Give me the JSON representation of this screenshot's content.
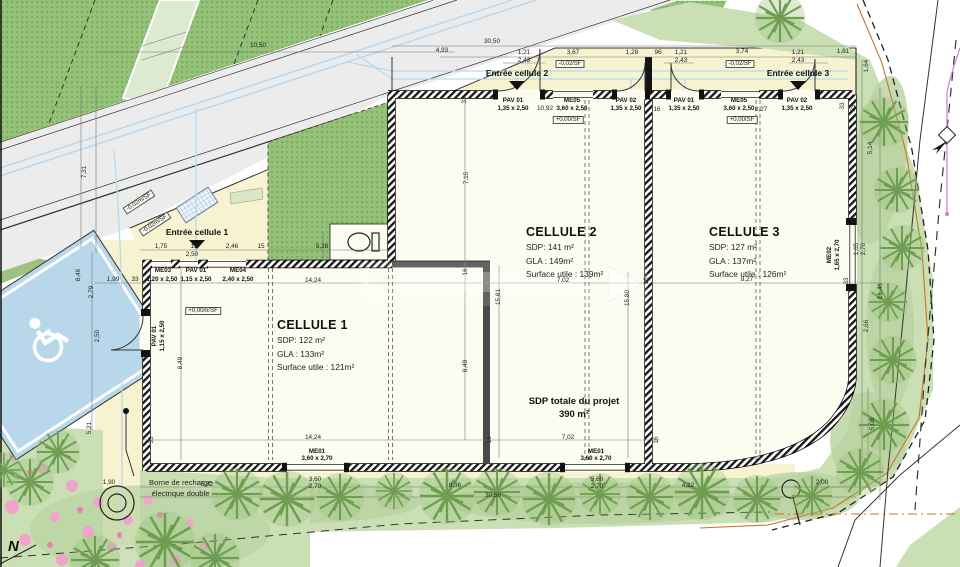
{
  "plan_title": "Plan de masse - projet de 3 cellules commerciales",
  "cells": [
    {
      "title": "CELLULE 1",
      "sdp": "SDP: 122 m²",
      "gla": "GLA : 133m²",
      "su": "Surface utile : 121m²"
    },
    {
      "title": "CELLULE 2",
      "sdp": "SDP: 141 m²",
      "gla": "GLA : 149m²",
      "su": "Surface utile : 139m²"
    },
    {
      "title": "CELLULE 3",
      "sdp": "SDP: 127 m²",
      "gla": "GLA : 137m²",
      "su": "Surface utile : 126m²"
    }
  ],
  "total": {
    "line1": "SDP totale du projet",
    "line2": "390 m²"
  },
  "charging": {
    "line1": "Borne de recharge",
    "line2": "électrique double"
  },
  "north": "N",
  "colors": {
    "site_yellow": "#f7f3d0",
    "building_white": "#fdfcf1",
    "parcel_green": "#94c279",
    "verge_green": "#cadfb4",
    "parking_blue": "#b9d7ea",
    "utility_blue": "#b7d9ee",
    "boundary_orange": "#c8732d",
    "utility_purple": "#c983c9",
    "flower_pink": "#f0a4cc"
  },
  "labels": [
    {
      "t": "10,50",
      "x": 258,
      "y": 46
    },
    {
      "t": "30,50",
      "x": 492,
      "y": 42
    },
    {
      "t": "4,93",
      "x": 442,
      "y": 51
    },
    {
      "t": "1,21",
      "x": 524,
      "y": 53
    },
    {
      "t": "2,43",
      "x": 524,
      "y": 61
    },
    {
      "t": "3,67",
      "x": 573,
      "y": 53
    },
    {
      "t": "1,28",
      "x": 632,
      "y": 53
    },
    {
      "t": "96",
      "x": 658,
      "y": 53
    },
    {
      "t": "1,21",
      "x": 681,
      "y": 53
    },
    {
      "t": "2,43",
      "x": 681,
      "y": 61
    },
    {
      "t": "3,74",
      "x": 742,
      "y": 52
    },
    {
      "t": "1,21",
      "x": 798,
      "y": 53
    },
    {
      "t": "2,43",
      "x": 798,
      "y": 61
    },
    {
      "t": "1,81",
      "x": 843,
      "y": 52
    },
    {
      "t": "7,31",
      "x": 85,
      "y": 172,
      "r": -90
    },
    {
      "t": "1,64",
      "x": 867,
      "y": 66,
      "r": -90
    },
    {
      "t": "33",
      "x": 843,
      "y": 106,
      "r": -90
    },
    {
      "t": "5,14",
      "x": 871,
      "y": 148,
      "r": -90
    },
    {
      "t": "33",
      "x": 465,
      "y": 100,
      "r": -90
    },
    {
      "t": "10,92",
      "x": 545,
      "y": 109
    },
    {
      "t": "16",
      "x": 657,
      "y": 110
    },
    {
      "t": "8,27",
      "x": 761,
      "y": 110
    },
    {
      "t": "33",
      "x": 854,
      "y": 108,
      "r": -90
    },
    {
      "t": "7,15",
      "x": 467,
      "y": 178,
      "r": -90
    },
    {
      "t": "5,28",
      "x": 322,
      "y": 247
    },
    {
      "t": "1,75",
      "x": 161,
      "y": 247
    },
    {
      "t": "15",
      "x": 194,
      "y": 247
    },
    {
      "t": "2,46",
      "x": 232,
      "y": 247
    },
    {
      "t": "15",
      "x": 261,
      "y": 247
    },
    {
      "t": "2,50",
      "x": 192,
      "y": 255
    },
    {
      "t": "1,99",
      "x": 113,
      "y": 280
    },
    {
      "t": "33",
      "x": 135,
      "y": 280
    },
    {
      "t": "2,79",
      "x": 92,
      "y": 292,
      "r": -90
    },
    {
      "t": "2,50",
      "x": 98,
      "y": 336,
      "r": -90
    },
    {
      "t": "8,46",
      "x": 79,
      "y": 275,
      "r": -90
    },
    {
      "t": "5,21",
      "x": 90,
      "y": 428,
      "r": -90
    },
    {
      "t": "14,24",
      "x": 313,
      "y": 281
    },
    {
      "t": "16",
      "x": 466,
      "y": 272,
      "r": -90
    },
    {
      "t": "15,81",
      "x": 499,
      "y": 297,
      "r": -90
    },
    {
      "t": "7,02",
      "x": 563,
      "y": 281
    },
    {
      "t": "16",
      "x": 647,
      "y": 281,
      "r": -90
    },
    {
      "t": "8,27",
      "x": 747,
      "y": 280
    },
    {
      "t": "33",
      "x": 847,
      "y": 281,
      "r": -90
    },
    {
      "t": "1,65",
      "x": 857,
      "y": 249,
      "r": -90
    },
    {
      "t": "2,70",
      "x": 864,
      "y": 249,
      "r": -90
    },
    {
      "t": "15,80",
      "x": 628,
      "y": 298,
      "r": -90
    },
    {
      "t": "8,49",
      "x": 181,
      "y": 363,
      "r": -90
    },
    {
      "t": "8,49",
      "x": 466,
      "y": 366,
      "r": -90
    },
    {
      "t": "16,46",
      "x": 881,
      "y": 291,
      "r": -90
    },
    {
      "t": "2,66",
      "x": 867,
      "y": 326,
      "r": -90
    },
    {
      "t": "33",
      "x": 152,
      "y": 440,
      "r": -90
    },
    {
      "t": "14,24",
      "x": 313,
      "y": 438
    },
    {
      "t": "16",
      "x": 490,
      "y": 440,
      "r": -90
    },
    {
      "t": "7,02",
      "x": 568,
      "y": 438
    },
    {
      "t": "16",
      "x": 657,
      "y": 440,
      "r": -90
    },
    {
      "t": "5,82",
      "x": 207,
      "y": 485
    },
    {
      "t": "3,60",
      "x": 315,
      "y": 480
    },
    {
      "t": "2,70",
      "x": 315,
      "y": 487
    },
    {
      "t": "8,36",
      "x": 455,
      "y": 486
    },
    {
      "t": "3,60",
      "x": 597,
      "y": 480
    },
    {
      "t": "2,70",
      "x": 597,
      "y": 487
    },
    {
      "t": "4,12",
      "x": 688,
      "y": 486
    },
    {
      "t": "2,00",
      "x": 822,
      "y": 483
    },
    {
      "t": "30,50",
      "x": 493,
      "y": 496
    },
    {
      "t": "5,00",
      "x": 873,
      "y": 424,
      "r": -90
    },
    {
      "t": "1,90",
      "x": 109,
      "y": 483
    },
    {
      "t": "PAV 01",
      "x": 513,
      "y": 101,
      "c": "opn",
      "n": "opening-label"
    },
    {
      "t": "1,35 x 2,50",
      "x": 513,
      "y": 109,
      "c": "opn",
      "n": "opening-size"
    },
    {
      "t": "ME05",
      "x": 572,
      "y": 101,
      "c": "opn",
      "n": "opening-label"
    },
    {
      "t": "3,60 x 2,50",
      "x": 572,
      "y": 109,
      "c": "opn",
      "n": "opening-size"
    },
    {
      "t": "PAV 02",
      "x": 626,
      "y": 101,
      "c": "opn",
      "n": "opening-label"
    },
    {
      "t": "1,35 x 2,50",
      "x": 626,
      "y": 109,
      "c": "opn",
      "n": "opening-size"
    },
    {
      "t": "PAV 01",
      "x": 684,
      "y": 101,
      "c": "opn",
      "n": "opening-label"
    },
    {
      "t": "1,35 x 2,50",
      "x": 684,
      "y": 109,
      "c": "opn",
      "n": "opening-size"
    },
    {
      "t": "ME05",
      "x": 739,
      "y": 101,
      "c": "opn",
      "n": "opening-label"
    },
    {
      "t": "3,60 x 2,50",
      "x": 739,
      "y": 109,
      "c": "opn",
      "n": "opening-size"
    },
    {
      "t": "PAV 02",
      "x": 797,
      "y": 101,
      "c": "opn",
      "n": "opening-label"
    },
    {
      "t": "1,35 x 2,50",
      "x": 797,
      "y": 109,
      "c": "opn",
      "n": "opening-size"
    },
    {
      "t": "ME03",
      "x": 163,
      "y": 271,
      "c": "opn",
      "n": "opening-label"
    },
    {
      "t": "1,20 x 2,50",
      "x": 162,
      "y": 280,
      "c": "opn",
      "n": "opening-size"
    },
    {
      "t": "PAV 01",
      "x": 196,
      "y": 271,
      "c": "opn",
      "n": "opening-label"
    },
    {
      "t": "1,15 x 2,50",
      "x": 196,
      "y": 280,
      "c": "opn",
      "n": "opening-size"
    },
    {
      "t": "ME04",
      "x": 238,
      "y": 271,
      "c": "opn",
      "n": "opening-label"
    },
    {
      "t": "2,40 x 2,50",
      "x": 238,
      "y": 280,
      "c": "opn",
      "n": "opening-size"
    },
    {
      "t": "PAV 01",
      "x": 155,
      "y": 336,
      "r": -90,
      "c": "opn",
      "n": "opening-label"
    },
    {
      "t": "1,15 x 2,50",
      "x": 163,
      "y": 336,
      "r": -90,
      "c": "opn",
      "n": "opening-size"
    },
    {
      "t": "ME02",
      "x": 830,
      "y": 255,
      "r": -90,
      "c": "opn",
      "n": "opening-label"
    },
    {
      "t": "1,65 x 2,70",
      "x": 838,
      "y": 255,
      "r": -90,
      "c": "opn",
      "n": "opening-size"
    },
    {
      "t": "ME01",
      "x": 317,
      "y": 452,
      "c": "opn",
      "n": "opening-label"
    },
    {
      "t": "3,60 x 2,70",
      "x": 317,
      "y": 459,
      "c": "opn",
      "n": "opening-size"
    },
    {
      "t": "ME01",
      "x": 596,
      "y": 452,
      "c": "opn",
      "n": "opening-label"
    },
    {
      "t": "3,60 x 2,70",
      "x": 596,
      "y": 459,
      "c": "opn",
      "n": "opening-size"
    },
    {
      "t": "-0,02/SF",
      "x": 570,
      "y": 64,
      "c": "lvl",
      "n": "level-badge"
    },
    {
      "t": "-0,02/SF",
      "x": 740,
      "y": 64,
      "c": "lvl",
      "n": "level-badge"
    },
    {
      "t": "+0,00/SF",
      "x": 568,
      "y": 120,
      "c": "lvl",
      "n": "level-badge"
    },
    {
      "t": "+0,00/SF",
      "x": 742,
      "y": 120,
      "c": "lvl",
      "n": "level-badge"
    },
    {
      "t": "+0,00m/SF",
      "x": 203,
      "y": 311,
      "c": "lvl",
      "n": "level-badge"
    },
    {
      "t": "-0,02m/SF",
      "x": 139,
      "y": 202,
      "r": -33,
      "c": "lvl",
      "n": "level-badge"
    },
    {
      "t": "-0,02m/SF",
      "x": 155,
      "y": 224,
      "r": -33,
      "c": "lvl",
      "n": "level-badge"
    },
    {
      "t": "Entrée cellule 1",
      "x": 197,
      "y": 232,
      "c": "ent",
      "n": "entrance-label"
    },
    {
      "t": "Entrée cellule 2",
      "x": 517,
      "y": 73,
      "c": "ent",
      "n": "entrance-label"
    },
    {
      "t": "Entrée cellule 3",
      "x": 798,
      "y": 73,
      "c": "ent",
      "n": "entrance-label"
    }
  ]
}
